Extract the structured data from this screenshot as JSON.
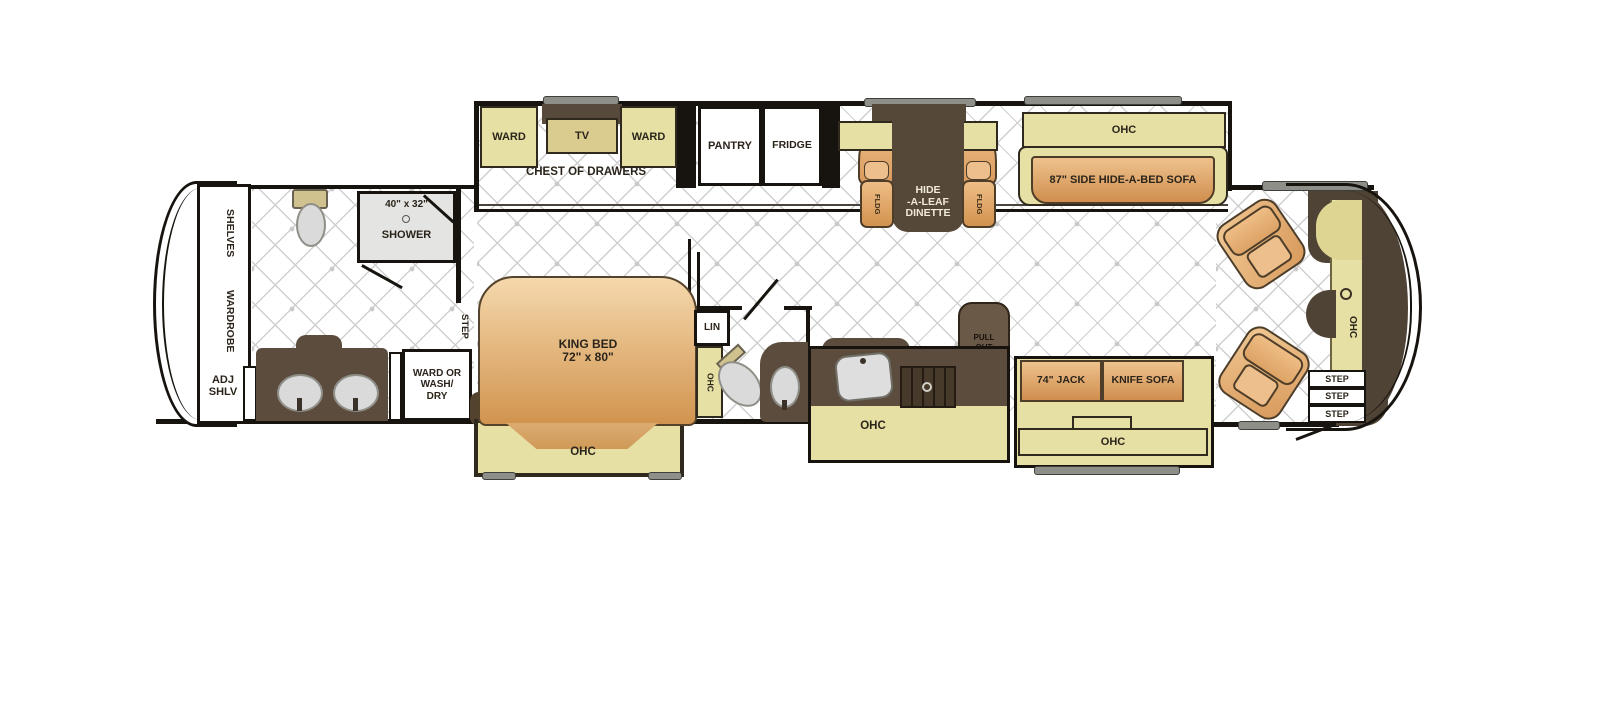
{
  "colors": {
    "wall": "#17130e",
    "cabinet": "#e7e0a4",
    "wood": "#5c4c3d",
    "upholstery": "#e2ab72",
    "front_cap": "#4f4335",
    "floor_line": "#cfcfcf",
    "fixture": "#dcdcdc",
    "slide_topper": "#8f8f89"
  },
  "rear": {
    "shelves": "SHELVES",
    "wardrobe": "WARDROBE",
    "adj_shlv": "ADJ SHLV"
  },
  "rear_bath": {
    "shower_size": "40\" x 32\"",
    "shower": "SHOWER",
    "wash_dry": [
      "WARD OR",
      "WASH/",
      "DRY"
    ],
    "step": "STEP"
  },
  "bedroom": {
    "ward_left": "WARD",
    "tv": "TV",
    "ward_right": "WARD",
    "chest": "CHEST OF DRAWERS",
    "bed_line1": "KING BED",
    "bed_line2": "72\" x 80\"",
    "ohc": "OHC"
  },
  "mid_bath": {
    "lin": "LIN",
    "ohc": "OHC"
  },
  "kitchen": {
    "pantry": "PANTRY",
    "fridge": "FRIDGE",
    "pull_out": [
      "PULL",
      "OUT",
      "CAB."
    ],
    "ohc": "OHC"
  },
  "dinette": {
    "ohc": "OHC",
    "table": [
      "HIDE",
      "-A-LEAF",
      "DINETTE"
    ],
    "fldg": "FLDG"
  },
  "living": {
    "ohc": "OHC",
    "sofa": "87\" SIDE HIDE-A-BED SOFA",
    "jack": "74\" JACK",
    "knife": "KNIFE SOFA",
    "ohc2": "OHC"
  },
  "front": {
    "ohc": "OHC",
    "steps": [
      "STEP",
      "STEP",
      "STEP"
    ]
  }
}
